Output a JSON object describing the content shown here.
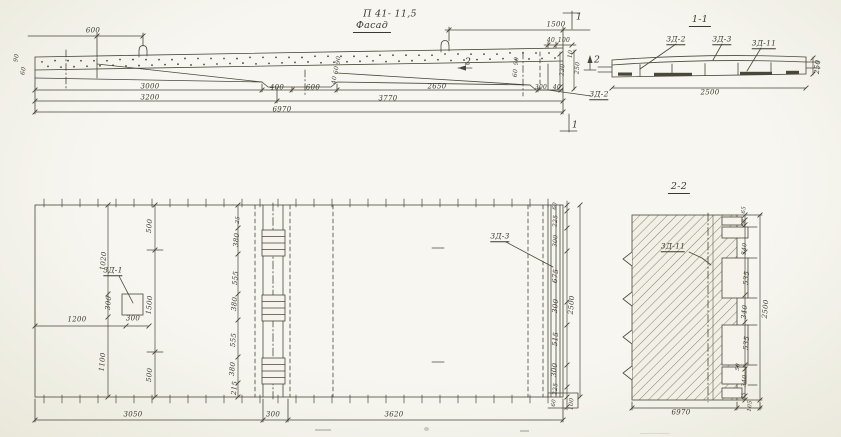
{
  "drawing": {
    "code": "П 41- 11,5",
    "facade_label": "Фасад",
    "section_1_label": "1-1",
    "section_2_label": "2-2"
  },
  "part_marks": [
    "3Д-1",
    "3Д-2",
    "3Д-3",
    "3Д-11"
  ],
  "colors": {
    "paper": "#f5f3ec",
    "ink": "#4a4639"
  },
  "annotations": [
    {
      "t": "П 41- 11,5",
      "x": 390,
      "y": 14,
      "k": "title"
    },
    {
      "t": "Фасад",
      "x": 372,
      "y": 27,
      "k": "title tu"
    },
    {
      "t": "1-1",
      "x": 700,
      "y": 21,
      "k": "title tu"
    },
    {
      "t": "2-2",
      "x": 679,
      "y": 188,
      "k": "title tu"
    },
    {
      "t": "600",
      "x": 93,
      "y": 31
    },
    {
      "t": "1500",
      "x": 556,
      "y": 25
    },
    {
      "t": "90",
      "x": 17,
      "y": 58,
      "r": -80,
      "fs": 6
    },
    {
      "t": "60",
      "x": 24,
      "y": 71,
      "r": -80,
      "fs": 6
    },
    {
      "t": "90",
      "x": 339,
      "y": 60,
      "r": -85,
      "fs": 6
    },
    {
      "t": "60",
      "x": 337,
      "y": 70,
      "r": -85,
      "fs": 6
    },
    {
      "t": "40",
      "x": 335,
      "y": 80,
      "r": -85,
      "fs": 6
    },
    {
      "t": "90",
      "x": 517,
      "y": 61,
      "r": -85,
      "fs": 6
    },
    {
      "t": "60",
      "x": 516,
      "y": 73,
      "r": -85,
      "fs": 6
    },
    {
      "t": "40",
      "x": 551,
      "y": 41,
      "fs": 6
    },
    {
      "t": "100",
      "x": 564,
      "y": 41,
      "fs": 6
    },
    {
      "t": "10",
      "x": 571,
      "y": 54,
      "r": -85,
      "fs": 6
    },
    {
      "t": "230",
      "x": 563,
      "y": 70,
      "r": -85,
      "fs": 6
    },
    {
      "t": "250",
      "x": 578,
      "y": 68,
      "r": -85,
      "fs": 6
    },
    {
      "t": "3000",
      "x": 150,
      "y": 87
    },
    {
      "t": "400",
      "x": 277,
      "y": 88
    },
    {
      "t": "600",
      "x": 313,
      "y": 88
    },
    {
      "t": "2650",
      "x": 437,
      "y": 87
    },
    {
      "t": "300",
      "x": 541,
      "y": 88,
      "fs": 6
    },
    {
      "t": "40",
      "x": 557,
      "y": 88,
      "fs": 6
    },
    {
      "t": "3200",
      "x": 150,
      "y": 98
    },
    {
      "t": "3770",
      "x": 388,
      "y": 99
    },
    {
      "t": "6970",
      "x": 282,
      "y": 110
    },
    {
      "t": "2",
      "x": 468,
      "y": 62,
      "k": "marker"
    },
    {
      "t": "2",
      "x": 597,
      "y": 60,
      "k": "marker"
    },
    {
      "t": "1",
      "x": 579,
      "y": 17,
      "k": "marker"
    },
    {
      "t": "1",
      "x": 575,
      "y": 125,
      "k": "marker"
    },
    {
      "t": "3Д-2",
      "x": 599,
      "y": 95,
      "k": "part"
    },
    {
      "t": "3Д-2",
      "x": 676,
      "y": 40,
      "k": "part"
    },
    {
      "t": "3Д-3",
      "x": 722,
      "y": 40,
      "k": "part"
    },
    {
      "t": "3Д-11",
      "x": 764,
      "y": 44,
      "k": "part"
    },
    {
      "t": "2500",
      "x": 710,
      "y": 93
    },
    {
      "t": "250",
      "x": 818,
      "y": 67,
      "r": -85
    },
    {
      "t": "500",
      "x": 150,
      "y": 226,
      "r": -85
    },
    {
      "t": "1020",
      "x": 104,
      "y": 261,
      "r": -85
    },
    {
      "t": "3Д-1",
      "x": 113,
      "y": 271,
      "k": "part"
    },
    {
      "t": "300",
      "x": 109,
      "y": 303,
      "r": -85
    },
    {
      "t": "1500",
      "x": 150,
      "y": 305,
      "r": -85
    },
    {
      "t": "1200",
      "x": 77,
      "y": 320
    },
    {
      "t": "300",
      "x": 133,
      "y": 319
    },
    {
      "t": "1100",
      "x": 103,
      "y": 362,
      "r": -85
    },
    {
      "t": "500",
      "x": 150,
      "y": 375,
      "r": -85
    },
    {
      "t": "25",
      "x": 239,
      "y": 220,
      "r": -85,
      "fs": 5.5
    },
    {
      "t": "380",
      "x": 237,
      "y": 240,
      "r": -85
    },
    {
      "t": "555",
      "x": 236,
      "y": 278,
      "r": -85
    },
    {
      "t": "380",
      "x": 235,
      "y": 304,
      "r": -85
    },
    {
      "t": "555",
      "x": 234,
      "y": 340,
      "r": -85
    },
    {
      "t": "380",
      "x": 233,
      "y": 369,
      "r": -85
    },
    {
      "t": "215",
      "x": 235,
      "y": 388,
      "r": -85
    },
    {
      "t": "3Д-3",
      "x": 500,
      "y": 237,
      "k": "part"
    },
    {
      "t": "60",
      "x": 556,
      "y": 206,
      "r": -85,
      "fs": 5.5
    },
    {
      "t": "225",
      "x": 556,
      "y": 221,
      "r": -85,
      "fs": 6
    },
    {
      "t": "300",
      "x": 556,
      "y": 241,
      "r": -85,
      "fs": 6
    },
    {
      "t": "675",
      "x": 556,
      "y": 276,
      "r": -85
    },
    {
      "t": "300",
      "x": 556,
      "y": 306,
      "r": -85
    },
    {
      "t": "515",
      "x": 556,
      "y": 339,
      "r": -85
    },
    {
      "t": "300",
      "x": 555,
      "y": 370,
      "r": -85
    },
    {
      "t": "225",
      "x": 556,
      "y": 389,
      "r": -85,
      "fs": 6
    },
    {
      "t": "60",
      "x": 555,
      "y": 403,
      "r": -85,
      "fs": 5.5
    },
    {
      "t": "2500",
      "x": 572,
      "y": 305,
      "r": -85
    },
    {
      "t": "3050",
      "x": 133,
      "y": 415
    },
    {
      "t": "300",
      "x": 273,
      "y": 415
    },
    {
      "t": "3620",
      "x": 394,
      "y": 415
    },
    {
      "t": "100",
      "x": 572,
      "y": 404,
      "r": -85,
      "fs": 6
    },
    {
      "t": "3Д-11",
      "x": 673,
      "y": 247,
      "k": "part"
    },
    {
      "t": "65",
      "x": 745,
      "y": 210,
      "r": -85,
      "fs": 5.5
    },
    {
      "t": "60",
      "x": 745,
      "y": 223,
      "r": -85,
      "fs": 5.5
    },
    {
      "t": "340",
      "x": 745,
      "y": 249,
      "r": -85,
      "fs": 6
    },
    {
      "t": "535",
      "x": 747,
      "y": 278,
      "r": -85
    },
    {
      "t": "340",
      "x": 745,
      "y": 312,
      "r": -85
    },
    {
      "t": "535",
      "x": 747,
      "y": 343,
      "r": -85
    },
    {
      "t": "50",
      "x": 739,
      "y": 367,
      "r": -85,
      "fs": 5.5
    },
    {
      "t": "340",
      "x": 745,
      "y": 381,
      "r": -85,
      "fs": 6
    },
    {
      "t": "65",
      "x": 745,
      "y": 396,
      "r": -85,
      "fs": 5.5
    },
    {
      "t": "2500",
      "x": 766,
      "y": 309,
      "r": -85
    },
    {
      "t": "105",
      "x": 751,
      "y": 406,
      "r": -85,
      "fs": 5.5
    },
    {
      "t": "6970",
      "x": 681,
      "y": 413
    }
  ]
}
